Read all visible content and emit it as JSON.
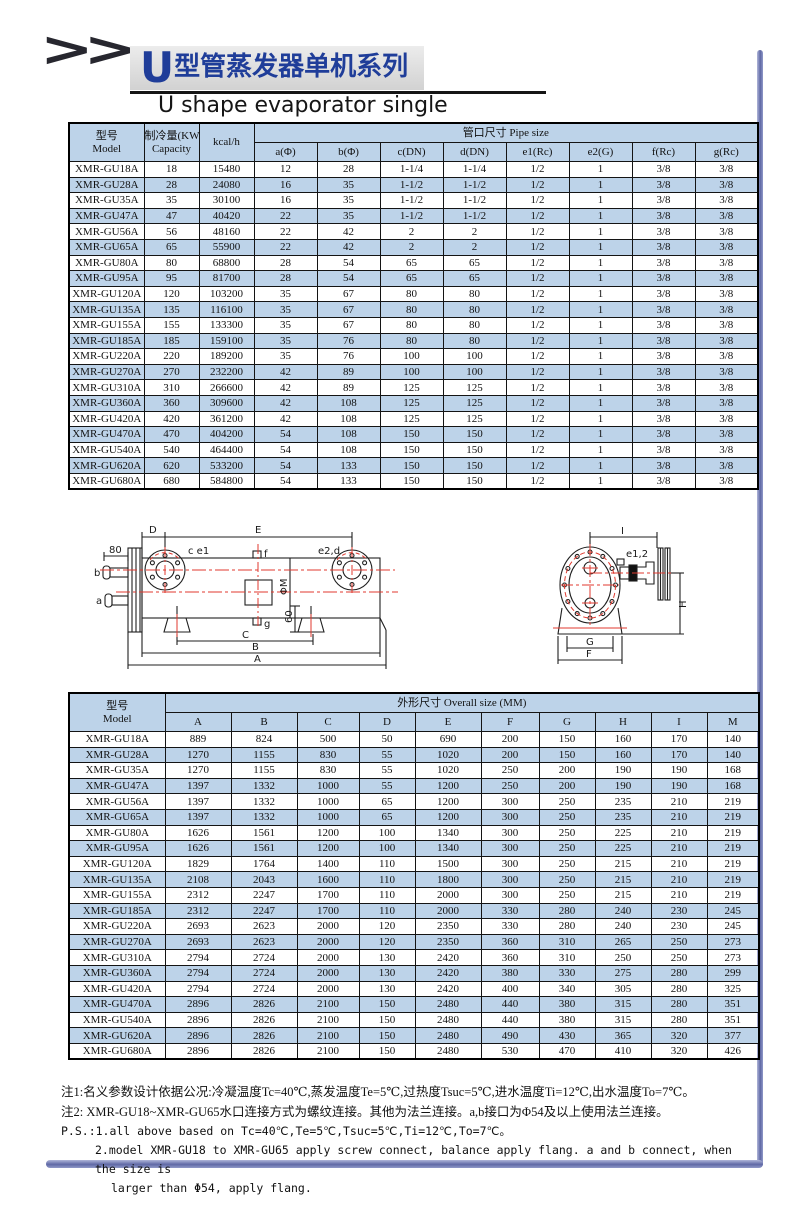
{
  "header": {
    "chevrons": ">>",
    "title_initial": "U",
    "title_cn_rest": "型管蒸发器单机系列",
    "subtitle_en": "U shape evaporator single"
  },
  "colors": {
    "title_blue": "#1f3d99",
    "row_blue": "#bdd3e9",
    "bar_purple": "#5f68a5",
    "centerline_red": "#e03a2f"
  },
  "pipe_table": {
    "header": {
      "model_cn": "型号",
      "model_en": "Model",
      "capacity_cn": "制冷量(KW)",
      "capacity_en": "Capacity",
      "kcal": "kcal/h",
      "group_title": "管口尺寸 Pipe size",
      "cols": [
        "a(Φ)",
        "b(Φ)",
        "c(DN)",
        "d(DN)",
        "e1(Rc)",
        "e2(G)",
        "f(Rc)",
        "g(Rc)"
      ]
    },
    "rows": [
      [
        "XMR-GU18A",
        "18",
        "15480",
        "12",
        "28",
        "1-1/4",
        "1-1/4",
        "1/2",
        "1",
        "3/8",
        "3/8"
      ],
      [
        "XMR-GU28A",
        "28",
        "24080",
        "16",
        "35",
        "1-1/2",
        "1-1/2",
        "1/2",
        "1",
        "3/8",
        "3/8"
      ],
      [
        "XMR-GU35A",
        "35",
        "30100",
        "16",
        "35",
        "1-1/2",
        "1-1/2",
        "1/2",
        "1",
        "3/8",
        "3/8"
      ],
      [
        "XMR-GU47A",
        "47",
        "40420",
        "22",
        "35",
        "1-1/2",
        "1-1/2",
        "1/2",
        "1",
        "3/8",
        "3/8"
      ],
      [
        "XMR-GU56A",
        "56",
        "48160",
        "22",
        "42",
        "2",
        "2",
        "1/2",
        "1",
        "3/8",
        "3/8"
      ],
      [
        "XMR-GU65A",
        "65",
        "55900",
        "22",
        "42",
        "2",
        "2",
        "1/2",
        "1",
        "3/8",
        "3/8"
      ],
      [
        "XMR-GU80A",
        "80",
        "68800",
        "28",
        "54",
        "65",
        "65",
        "1/2",
        "1",
        "3/8",
        "3/8"
      ],
      [
        "XMR-GU95A",
        "95",
        "81700",
        "28",
        "54",
        "65",
        "65",
        "1/2",
        "1",
        "3/8",
        "3/8"
      ],
      [
        "XMR-GU120A",
        "120",
        "103200",
        "35",
        "67",
        "80",
        "80",
        "1/2",
        "1",
        "3/8",
        "3/8"
      ],
      [
        "XMR-GU135A",
        "135",
        "116100",
        "35",
        "67",
        "80",
        "80",
        "1/2",
        "1",
        "3/8",
        "3/8"
      ],
      [
        "XMR-GU155A",
        "155",
        "133300",
        "35",
        "67",
        "80",
        "80",
        "1/2",
        "1",
        "3/8",
        "3/8"
      ],
      [
        "XMR-GU185A",
        "185",
        "159100",
        "35",
        "76",
        "80",
        "80",
        "1/2",
        "1",
        "3/8",
        "3/8"
      ],
      [
        "XMR-GU220A",
        "220",
        "189200",
        "35",
        "76",
        "100",
        "100",
        "1/2",
        "1",
        "3/8",
        "3/8"
      ],
      [
        "XMR-GU270A",
        "270",
        "232200",
        "42",
        "89",
        "100",
        "100",
        "1/2",
        "1",
        "3/8",
        "3/8"
      ],
      [
        "XMR-GU310A",
        "310",
        "266600",
        "42",
        "89",
        "125",
        "125",
        "1/2",
        "1",
        "3/8",
        "3/8"
      ],
      [
        "XMR-GU360A",
        "360",
        "309600",
        "42",
        "108",
        "125",
        "125",
        "1/2",
        "1",
        "3/8",
        "3/8"
      ],
      [
        "XMR-GU420A",
        "420",
        "361200",
        "42",
        "108",
        "125",
        "125",
        "1/2",
        "1",
        "3/8",
        "3/8"
      ],
      [
        "XMR-GU470A",
        "470",
        "404200",
        "54",
        "108",
        "150",
        "150",
        "1/2",
        "1",
        "3/8",
        "3/8"
      ],
      [
        "XMR-GU540A",
        "540",
        "464400",
        "54",
        "108",
        "150",
        "150",
        "1/2",
        "1",
        "3/8",
        "3/8"
      ],
      [
        "XMR-GU620A",
        "620",
        "533200",
        "54",
        "133",
        "150",
        "150",
        "1/2",
        "1",
        "3/8",
        "3/8"
      ],
      [
        "XMR-GU680A",
        "680",
        "584800",
        "54",
        "133",
        "150",
        "150",
        "1/2",
        "1",
        "3/8",
        "3/8"
      ]
    ]
  },
  "size_table": {
    "header": {
      "model_cn": "型号",
      "model_en": "Model",
      "group_title": "外形尺寸 Overall size (MM)",
      "cols": [
        "A",
        "B",
        "C",
        "D",
        "E",
        "F",
        "G",
        "H",
        "I",
        "M"
      ]
    },
    "rows": [
      [
        "XMR-GU18A",
        "889",
        "824",
        "500",
        "50",
        "690",
        "200",
        "150",
        "160",
        "170",
        "140"
      ],
      [
        "XMR-GU28A",
        "1270",
        "1155",
        "830",
        "55",
        "1020",
        "200",
        "150",
        "160",
        "170",
        "140"
      ],
      [
        "XMR-GU35A",
        "1270",
        "1155",
        "830",
        "55",
        "1020",
        "250",
        "200",
        "190",
        "190",
        "168"
      ],
      [
        "XMR-GU47A",
        "1397",
        "1332",
        "1000",
        "55",
        "1200",
        "250",
        "200",
        "190",
        "190",
        "168"
      ],
      [
        "XMR-GU56A",
        "1397",
        "1332",
        "1000",
        "65",
        "1200",
        "300",
        "250",
        "235",
        "210",
        "219"
      ],
      [
        "XMR-GU65A",
        "1397",
        "1332",
        "1000",
        "65",
        "1200",
        "300",
        "250",
        "235",
        "210",
        "219"
      ],
      [
        "XMR-GU80A",
        "1626",
        "1561",
        "1200",
        "100",
        "1340",
        "300",
        "250",
        "225",
        "210",
        "219"
      ],
      [
        "XMR-GU95A",
        "1626",
        "1561",
        "1200",
        "100",
        "1340",
        "300",
        "250",
        "225",
        "210",
        "219"
      ],
      [
        "XMR-GU120A",
        "1829",
        "1764",
        "1400",
        "110",
        "1500",
        "300",
        "250",
        "215",
        "210",
        "219"
      ],
      [
        "XMR-GU135A",
        "2108",
        "2043",
        "1600",
        "110",
        "1800",
        "300",
        "250",
        "215",
        "210",
        "219"
      ],
      [
        "XMR-GU155A",
        "2312",
        "2247",
        "1700",
        "110",
        "2000",
        "300",
        "250",
        "215",
        "210",
        "219"
      ],
      [
        "XMR-GU185A",
        "2312",
        "2247",
        "1700",
        "110",
        "2000",
        "330",
        "280",
        "240",
        "230",
        "245"
      ],
      [
        "XMR-GU220A",
        "2693",
        "2623",
        "2000",
        "120",
        "2350",
        "330",
        "280",
        "240",
        "230",
        "245"
      ],
      [
        "XMR-GU270A",
        "2693",
        "2623",
        "2000",
        "120",
        "2350",
        "360",
        "310",
        "265",
        "250",
        "273"
      ],
      [
        "XMR-GU310A",
        "2794",
        "2724",
        "2000",
        "130",
        "2420",
        "360",
        "310",
        "250",
        "250",
        "273"
      ],
      [
        "XMR-GU360A",
        "2794",
        "2724",
        "2000",
        "130",
        "2420",
        "380",
        "330",
        "275",
        "280",
        "299"
      ],
      [
        "XMR-GU420A",
        "2794",
        "2724",
        "2000",
        "130",
        "2420",
        "400",
        "340",
        "305",
        "280",
        "325"
      ],
      [
        "XMR-GU470A",
        "2896",
        "2826",
        "2100",
        "150",
        "2480",
        "440",
        "380",
        "315",
        "280",
        "351"
      ],
      [
        "XMR-GU540A",
        "2896",
        "2826",
        "2100",
        "150",
        "2480",
        "440",
        "380",
        "315",
        "280",
        "351"
      ],
      [
        "XMR-GU620A",
        "2896",
        "2826",
        "2100",
        "150",
        "2480",
        "490",
        "430",
        "365",
        "320",
        "377"
      ],
      [
        "XMR-GU680A",
        "2896",
        "2826",
        "2100",
        "150",
        "2480",
        "530",
        "470",
        "410",
        "320",
        "426"
      ]
    ]
  },
  "drawing": {
    "labels": {
      "dim80": "80",
      "b": "b",
      "a": "a",
      "D": "D",
      "E": "E",
      "ce1": "c e1",
      "f": "f",
      "e2d": "e2,d",
      "phiM": "ΦM",
      "g": "g",
      "dim60": "60",
      "C": "C",
      "B": "B",
      "A": "A",
      "I": "I",
      "e12": "e1,2",
      "H": "H",
      "G": "G",
      "F": "F"
    }
  },
  "notes": {
    "note1": "注1:名义参数设计依据公况:冷凝温度Tc=40℃,蒸发温度Te=5℃,过热度Tsuc=5℃,进水温度Ti=12℃,出水温度To=7℃。",
    "note2": "注2: XMR-GU18~XMR-GU65水口连接方式为螺纹连接。其他为法兰连接。a,b接口为Φ54及以上使用法兰连接。",
    "ps1": "P.S.:1.all above based on Tc=40℃,Te=5℃,Tsuc=5℃,Ti=12℃,To=7℃。",
    "ps2": "2.model XMR-GU18 to XMR-GU65 apply screw connect, balance apply flang. a and b connect, when the size is",
    "ps3": "larger than Φ54, apply flang."
  }
}
